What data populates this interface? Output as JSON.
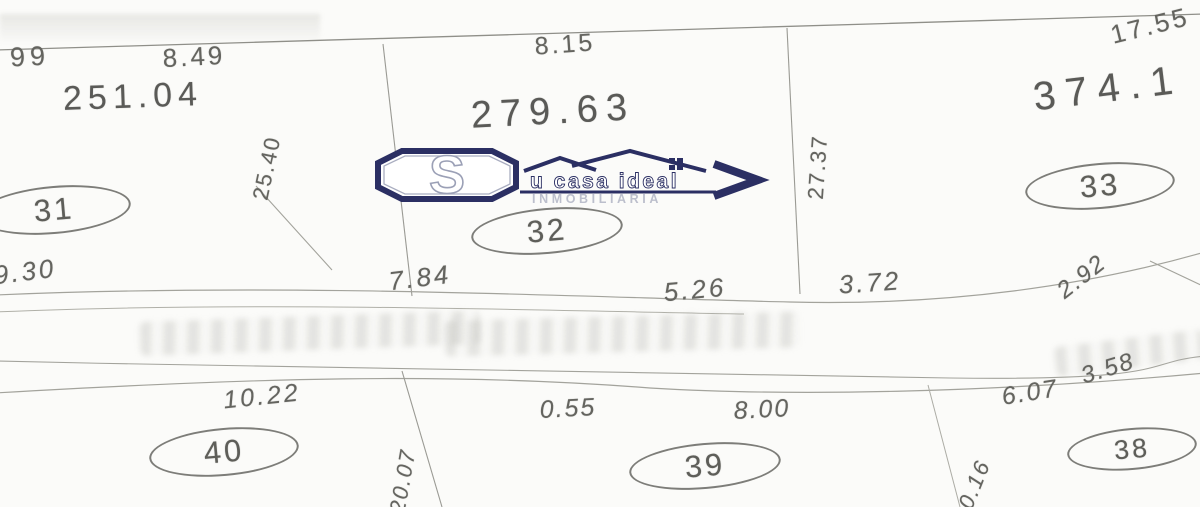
{
  "watermark": {
    "initial": "S",
    "name_rest": "u casa ideal",
    "subtitle": "INMOBILIARIA",
    "color": "#2b2f63"
  },
  "parcels": {
    "lot31": {
      "number": "31",
      "area": "251.04"
    },
    "lot32": {
      "number": "32",
      "area": "279.63"
    },
    "lot33": {
      "number": "33",
      "area": "374.1"
    },
    "lot38": {
      "number": "38"
    },
    "lot39": {
      "number": "39"
    },
    "lot40": {
      "number": "40"
    }
  },
  "dimensions": {
    "top_left_1": "99",
    "top_left_2": "8.49",
    "lot32_top": "8.15",
    "top_right": "17.55",
    "lot32_left_side": "25.40",
    "lot32_right_side": "27.37",
    "lot31_bottom": "9.30",
    "lot32_bottom_1": "7.84",
    "lot32_bottom_2": "5.26",
    "lot33_bottom_1": "3.72",
    "lot33_bottom_2": "2.92",
    "lot40_top": "10.22",
    "lot39_top_1": "0.55",
    "lot39_top_2": "8.00",
    "lot38_top_1": "6.07",
    "lot38_top_2": "3.58",
    "lot40_side": "20.07",
    "lot39_side": "20.16"
  }
}
